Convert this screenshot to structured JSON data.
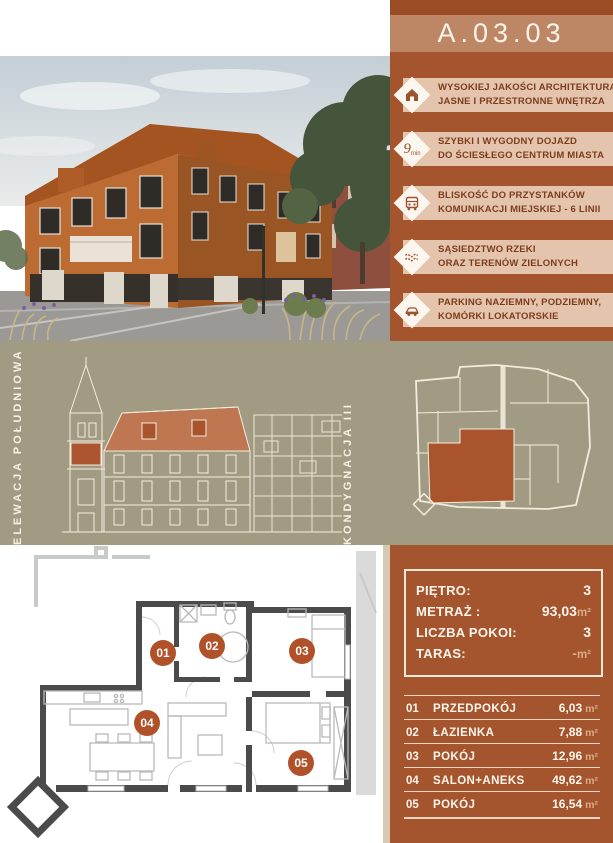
{
  "unit": {
    "code": "A.03.03"
  },
  "features": [
    {
      "icon": "house-icon",
      "lines": [
        "WYSOKIEJ JAKOŚCI ARCHITEKTURA",
        "JASNE I PRZESTRONNE WNĘTRZA"
      ]
    },
    {
      "icon": "nine-minutes-icon",
      "icon_big": "9",
      "icon_small": "min",
      "lines": [
        "SZYBKI I WYGODNY DOJAZD",
        "DO ŚCIESŁEGO CENTRUM MIASTA"
      ]
    },
    {
      "icon": "bus-icon",
      "lines": [
        "BLISKOŚĆ DO PRZYSTANKÓW",
        "KOMUNIKACJI MIEJSKIEJ - 6 LINII"
      ]
    },
    {
      "icon": "river-icon",
      "lines": [
        "SĄSIEDZTWO RZEKI",
        "ORAZ TERENÓW ZIELONYCH"
      ]
    },
    {
      "icon": "car-icon",
      "lines": [
        "PARKING NAZIEMNY, PODZIEMNY,",
        "KOMÓRKI LOKATORSKIE"
      ]
    }
  ],
  "middle": {
    "left_vertical_label": "ELEWACJA POŁUDNIOWA",
    "right_vertical_label": "KONDYGNACJA III"
  },
  "summary": {
    "rows": [
      {
        "label": "PIĘTRO:",
        "value": "3",
        "unit": ""
      },
      {
        "label": "METRAŻ :",
        "value": "93,03",
        "unit": "m²"
      },
      {
        "label": "LICZBA POKOI:",
        "value": "3",
        "unit": ""
      },
      {
        "label": "TARAS:",
        "value": "-",
        "unit": "m²"
      }
    ]
  },
  "rooms": [
    {
      "no": "01",
      "name": "PRZEDPOKÓJ",
      "area": "6,03",
      "unit": "m²"
    },
    {
      "no": "02",
      "name": "ŁAZIENKA",
      "area": "7,88",
      "unit": "m²"
    },
    {
      "no": "03",
      "name": "POKÓJ",
      "area": "12,96",
      "unit": "m²"
    },
    {
      "no": "04",
      "name": "SALON+ANEKS",
      "area": "49,62",
      "unit": "m²"
    },
    {
      "no": "05",
      "name": "POKÓJ",
      "area": "16,54",
      "unit": "m²"
    }
  ],
  "plan": {
    "labels": [
      "01",
      "02",
      "03",
      "04",
      "05"
    ]
  },
  "colors": {
    "rust_panel": "#a4552e",
    "rust_dark": "#9a4c24",
    "header_band": "#bd8765",
    "feature_strip": "#e4c4ac",
    "feature_text": "#7c3d1d",
    "khaki_band": "#a29b83",
    "accent_circle": "#b0512a",
    "unit_text": "#d9ab89",
    "plan_wall": "#4b4b4b"
  }
}
